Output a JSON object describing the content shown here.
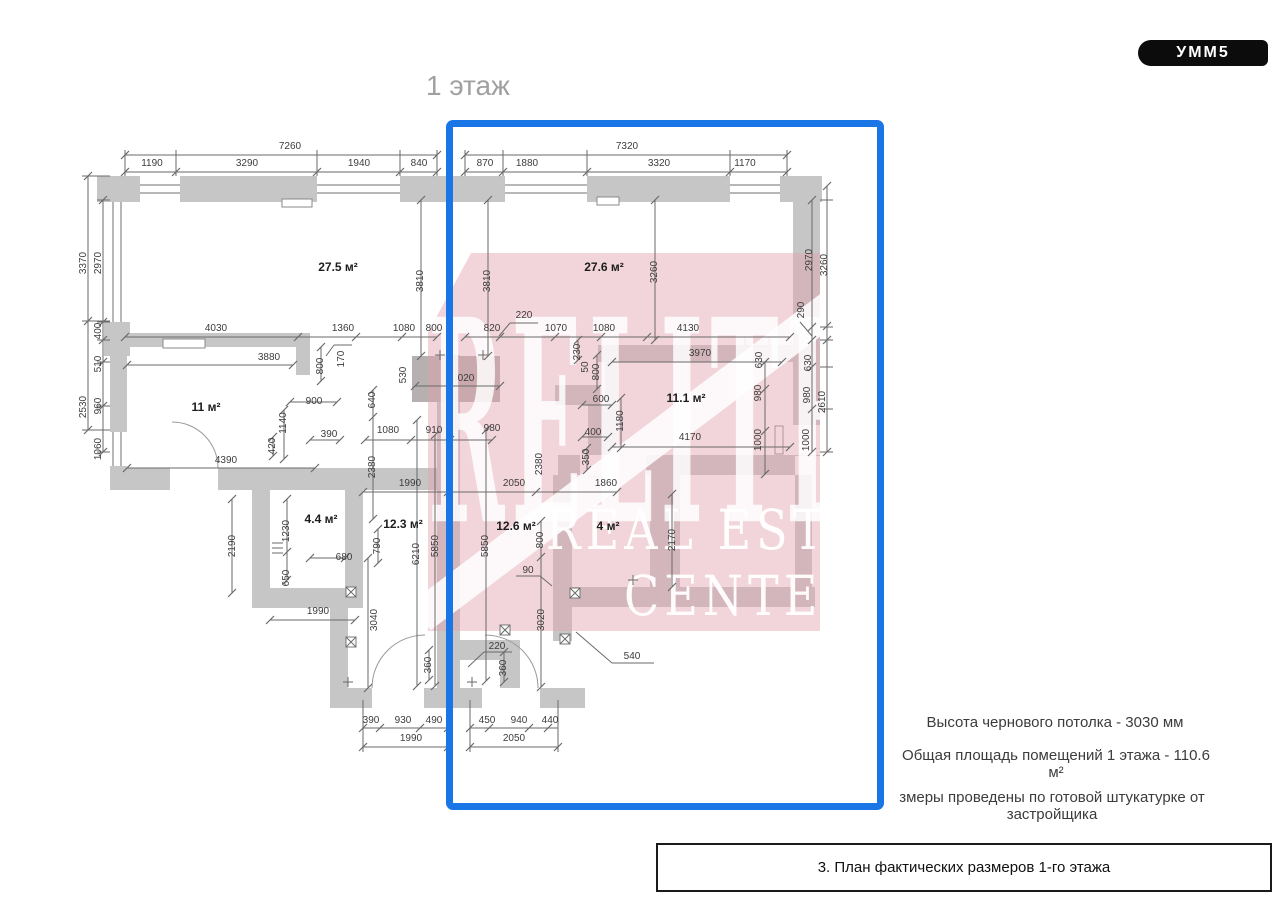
{
  "logo": {
    "text": "УММ5"
  },
  "title": "1 этаж",
  "watermark": {
    "big": "RELITE",
    "line1": "REAL ESTATE",
    "line2": "CENTER"
  },
  "notes": {
    "ceiling": "Высота чернового потолка - 3030 мм",
    "area": "Общая площадь помещений 1 этажа - 110.6 м²",
    "measure": "змеры проведены по готовой штукатурке от застройщика"
  },
  "caption": "3. План фактических размеров 1-го этажа",
  "colors": {
    "wall": "#c6c6c6",
    "lintel": "#b7b0b0",
    "dim_line": "#6a6a6a",
    "selection_blue": "#1a75e6",
    "watermark_pink": "#e2a2ae",
    "logo_bg": "#0c0c0c",
    "title_gray": "#a0a0a0"
  },
  "plan": {
    "rooms": [
      {
        "t": "27.5 м²",
        "x": 338,
        "y": 267
      },
      {
        "t": "27.6 м²",
        "x": 604,
        "y": 267
      },
      {
        "t": "11 м²",
        "x": 206,
        "y": 407
      },
      {
        "t": "11.1 м²",
        "x": 686,
        "y": 398
      },
      {
        "t": "4.4 м²",
        "x": 321,
        "y": 519
      },
      {
        "t": "12.3 м²",
        "x": 403,
        "y": 524
      },
      {
        "t": "12.6 м²",
        "x": 516,
        "y": 526
      },
      {
        "t": "4 м²",
        "x": 608,
        "y": 526
      }
    ],
    "dims": [
      {
        "t": "7260",
        "x": 290,
        "y": 147
      },
      {
        "t": "1190",
        "x": 152,
        "y": 164
      },
      {
        "t": "3290",
        "x": 247,
        "y": 164
      },
      {
        "t": "1940",
        "x": 359,
        "y": 164
      },
      {
        "t": "840",
        "x": 419,
        "y": 164
      },
      {
        "t": "7320",
        "x": 627,
        "y": 147
      },
      {
        "t": "870",
        "x": 485,
        "y": 164
      },
      {
        "t": "1880",
        "x": 527,
        "y": 164
      },
      {
        "t": "3320",
        "x": 659,
        "y": 164
      },
      {
        "t": "1170",
        "x": 745,
        "y": 164
      },
      {
        "t": "3370",
        "x": 84,
        "y": 263,
        "v": 1
      },
      {
        "t": "2970",
        "x": 99,
        "y": 263,
        "v": 1
      },
      {
        "t": "400",
        "x": 99,
        "y": 331,
        "v": 1
      },
      {
        "t": "510",
        "x": 99,
        "y": 364,
        "v": 1
      },
      {
        "t": "960",
        "x": 99,
        "y": 406,
        "v": 1
      },
      {
        "t": "2530",
        "x": 84,
        "y": 407,
        "v": 1
      },
      {
        "t": "1060",
        "x": 99,
        "y": 449,
        "v": 1
      },
      {
        "t": "2970",
        "x": 810,
        "y": 260,
        "v": 1
      },
      {
        "t": "3260",
        "x": 825,
        "y": 265,
        "v": 1
      },
      {
        "t": "290",
        "x": 802,
        "y": 310,
        "v": 1
      },
      {
        "t": "630",
        "x": 809,
        "y": 363,
        "v": 1
      },
      {
        "t": "980",
        "x": 808,
        "y": 395,
        "v": 1
      },
      {
        "t": "2610",
        "x": 823,
        "y": 402,
        "v": 1
      },
      {
        "t": "1000",
        "x": 807,
        "y": 440,
        "v": 1
      },
      {
        "t": "630",
        "x": 760,
        "y": 360,
        "v": 1
      },
      {
        "t": "980",
        "x": 759,
        "y": 393,
        "v": 1
      },
      {
        "t": "1000",
        "x": 759,
        "y": 440,
        "v": 1
      },
      {
        "t": "4030",
        "x": 216,
        "y": 329
      },
      {
        "t": "1360",
        "x": 343,
        "y": 329
      },
      {
        "t": "1080",
        "x": 404,
        "y": 329
      },
      {
        "t": "800",
        "x": 434,
        "y": 329
      },
      {
        "t": "820",
        "x": 492,
        "y": 329
      },
      {
        "t": "220",
        "x": 524,
        "y": 316
      },
      {
        "t": "1070",
        "x": 556,
        "y": 329
      },
      {
        "t": "1080",
        "x": 604,
        "y": 329
      },
      {
        "t": "4130",
        "x": 688,
        "y": 329
      },
      {
        "t": "3880",
        "x": 269,
        "y": 358
      },
      {
        "t": "3970",
        "x": 700,
        "y": 354
      },
      {
        "t": "3810",
        "x": 421,
        "y": 281,
        "v": 1
      },
      {
        "t": "3810",
        "x": 488,
        "y": 281,
        "v": 1
      },
      {
        "t": "3260",
        "x": 655,
        "y": 272,
        "v": 1
      },
      {
        "t": "800",
        "x": 321,
        "y": 366,
        "v": 1
      },
      {
        "t": "170",
        "x": 342,
        "y": 359,
        "v": 1
      },
      {
        "t": "530",
        "x": 404,
        "y": 375,
        "v": 1
      },
      {
        "t": "230",
        "x": 578,
        "y": 352,
        "v": 1
      },
      {
        "t": "50",
        "x": 586,
        "y": 367,
        "v": 1
      },
      {
        "t": "800",
        "x": 597,
        "y": 372,
        "v": 1
      },
      {
        "t": "640",
        "x": 373,
        "y": 400,
        "v": 1
      },
      {
        "t": "2380",
        "x": 373,
        "y": 467,
        "v": 1
      },
      {
        "t": "2380",
        "x": 540,
        "y": 464,
        "v": 1
      },
      {
        "t": "1080",
        "x": 388,
        "y": 431
      },
      {
        "t": "910",
        "x": 434,
        "y": 431
      },
      {
        "t": "980",
        "x": 492,
        "y": 429
      },
      {
        "t": "900",
        "x": 314,
        "y": 402
      },
      {
        "t": "1140",
        "x": 284,
        "y": 423,
        "v": 1
      },
      {
        "t": "390",
        "x": 329,
        "y": 435
      },
      {
        "t": "420",
        "x": 273,
        "y": 446,
        "v": 1
      },
      {
        "t": "4390",
        "x": 226,
        "y": 461
      },
      {
        "t": "600",
        "x": 601,
        "y": 400
      },
      {
        "t": "400",
        "x": 593,
        "y": 433
      },
      {
        "t": "1180",
        "x": 621,
        "y": 421,
        "v": 1
      },
      {
        "t": "350",
        "x": 587,
        "y": 457,
        "v": 1
      },
      {
        "t": "4170",
        "x": 690,
        "y": 438
      },
      {
        "t": "020",
        "x": 466,
        "y": 379
      },
      {
        "t": "1990",
        "x": 410,
        "y": 484
      },
      {
        "t": "2050",
        "x": 514,
        "y": 484
      },
      {
        "t": "1860",
        "x": 606,
        "y": 484
      },
      {
        "t": "2190",
        "x": 233,
        "y": 546,
        "v": 1
      },
      {
        "t": "1230",
        "x": 287,
        "y": 531,
        "v": 1
      },
      {
        "t": "650",
        "x": 287,
        "y": 578,
        "v": 1
      },
      {
        "t": "680",
        "x": 344,
        "y": 558
      },
      {
        "t": "790",
        "x": 378,
        "y": 546,
        "v": 1
      },
      {
        "t": "6210",
        "x": 417,
        "y": 554,
        "v": 1
      },
      {
        "t": "5850",
        "x": 436,
        "y": 546,
        "v": 1
      },
      {
        "t": "5850",
        "x": 486,
        "y": 546,
        "v": 1
      },
      {
        "t": "800",
        "x": 541,
        "y": 540,
        "v": 1
      },
      {
        "t": "90",
        "x": 528,
        "y": 571
      },
      {
        "t": "2170",
        "x": 673,
        "y": 540,
        "v": 1
      },
      {
        "t": "1990",
        "x": 318,
        "y": 612
      },
      {
        "t": "3040",
        "x": 375,
        "y": 620,
        "v": 1
      },
      {
        "t": "3020",
        "x": 542,
        "y": 620,
        "v": 1
      },
      {
        "t": "220",
        "x": 497,
        "y": 647
      },
      {
        "t": "360",
        "x": 429,
        "y": 665,
        "v": 1
      },
      {
        "t": "360",
        "x": 504,
        "y": 668,
        "v": 1
      },
      {
        "t": "540",
        "x": 632,
        "y": 657
      },
      {
        "t": "390",
        "x": 371,
        "y": 721
      },
      {
        "t": "930",
        "x": 403,
        "y": 721
      },
      {
        "t": "490",
        "x": 434,
        "y": 721
      },
      {
        "t": "1990",
        "x": 411,
        "y": 739
      },
      {
        "t": "450",
        "x": 487,
        "y": 721
      },
      {
        "t": "940",
        "x": 519,
        "y": 721
      },
      {
        "t": "440",
        "x": 550,
        "y": 721
      },
      {
        "t": "2050",
        "x": 514,
        "y": 739
      }
    ]
  }
}
